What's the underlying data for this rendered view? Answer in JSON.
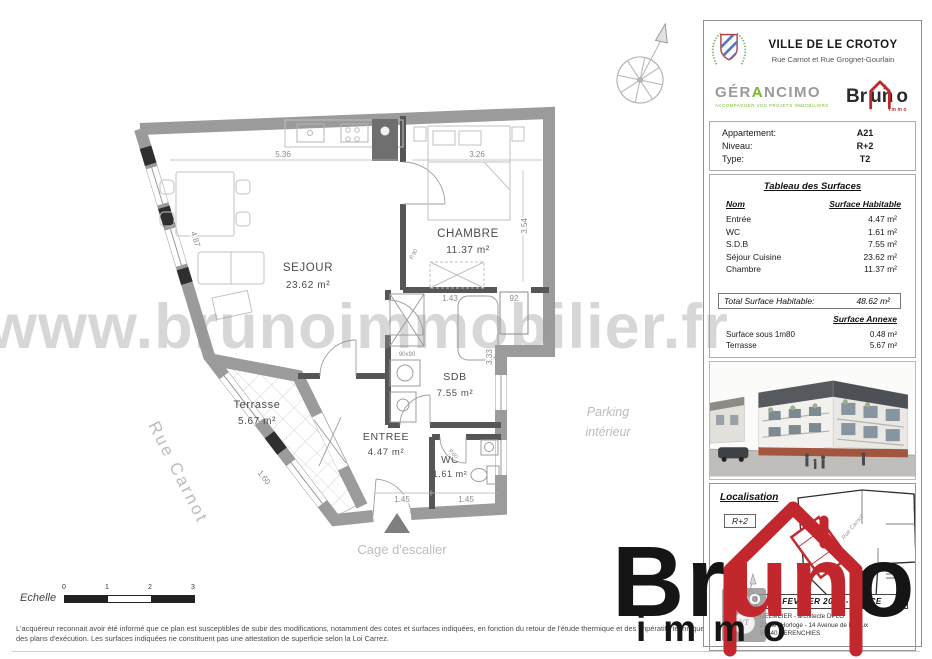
{
  "page": {
    "watermark": "www.brunoimmobilier.fr"
  },
  "header": {
    "title": "VILLE DE LE CROTOY",
    "subtitle": "Rue Carnot et Rue Grognet-Gourlain"
  },
  "logos": {
    "gerancimo_p1": "GÉR",
    "gerancimo_a": "A",
    "gerancimo_p2": "NCIMO",
    "gerancimo_tagline": "ACCOMPAGNER VOS PROJETS IMMOBILIERS",
    "bruno_br": "Br",
    "bruno_un": "un",
    "bruno_o": "o",
    "bruno_tagline": "immo"
  },
  "apartment": {
    "rows": [
      {
        "label": "Appartement:",
        "value": "A21"
      },
      {
        "label": "Niveau:",
        "value": "R+2"
      },
      {
        "label": "Type:",
        "value": "T2"
      }
    ]
  },
  "surfaces": {
    "title": "Tableau des Surfaces",
    "col_name": "Nom",
    "col_value": "Surface Habitable",
    "rows": [
      {
        "name": "Entrée",
        "value": "4.47 m²"
      },
      {
        "name": "WC",
        "value": "1.61 m²"
      },
      {
        "name": "S.D.B",
        "value": "7.55 m²"
      },
      {
        "name": "Séjour Cuisine",
        "value": "23.62 m²"
      },
      {
        "name": "Chambre",
        "value": "11.37 m²"
      }
    ],
    "total_label": "Total Surface Habitable:",
    "total_value": "48.62 m²",
    "annexe_title": "Surface Annexe",
    "annexe_rows": [
      {
        "name": "Surface sous 1m80",
        "value": "0.48 m²"
      },
      {
        "name": "Terrasse",
        "value": "5.67 m²"
      }
    ]
  },
  "localisation": {
    "title": "Localisation",
    "level": "R+2",
    "street": "Rue Carnot",
    "date": "FEVRIER 2022 - INDICE",
    "address_line1": "UELMEIER - architecte DPLG",
    "address_line2": "ZA de l'Horloge - 14 Avenue de Lisieux",
    "address_line3": "59840 PERENCHIES",
    "badge": "ADO",
    "stamp": "VT"
  },
  "plan": {
    "rooms": {
      "sejour": {
        "name": "SEJOUR",
        "area": "23.62 m²"
      },
      "chambre": {
        "name": "CHAMBRE",
        "area": "11.37 m²"
      },
      "sdb": {
        "name": "SDB",
        "area": "7.55 m²"
      },
      "entree": {
        "name": "ENTREE",
        "area": "4.47 m²"
      },
      "wc": {
        "name": "WC",
        "area": "1.61 m²"
      },
      "terrasse": {
        "name": "Terrasse",
        "area": "5.67 m²"
      }
    },
    "dims": {
      "top_left": "5.36",
      "top_right": "3.26",
      "right_side": "3.54",
      "left_side": "4.87",
      "hall": "1.43",
      "opening": "92",
      "sdb_side": "3.33",
      "bottom_left": "1.45",
      "bottom_right": "1.45",
      "terrace": "1.60",
      "shower": "90x90",
      "door_chambre": "P.90",
      "door_wc": "P.60"
    },
    "street": "Rue Carnot",
    "parking_line1": "Parking",
    "parking_line2": "intérieur",
    "stairwell": "Cage d'escalier"
  },
  "scale": {
    "label": "Echelle",
    "ticks": [
      "0",
      "1",
      "2",
      "3"
    ]
  },
  "disclaimer": {
    "line1": "L'acquéreur reconnait avoir été informé que ce plan est susceptibles de subir des modifications, notamment des cotes et surfaces indiquées, en fonction du retour de l'étude thermique et des impératifs techniques suite à la mise au point",
    "line2": "des plans d'exécution.  Les surfaces indiquées ne constituent pas une attestation de superficie selon la Loi Carrez."
  },
  "big_logo": {
    "p1": "Br",
    "p2": "un",
    "p3": "o",
    "sub": "immo"
  },
  "icons": {
    "compass": "compass-rose",
    "coat_of_arms": "le-crotoy-coat-of-arms",
    "bruno_house": "red-house-outline",
    "stair_marker": "entrance-triangle"
  }
}
